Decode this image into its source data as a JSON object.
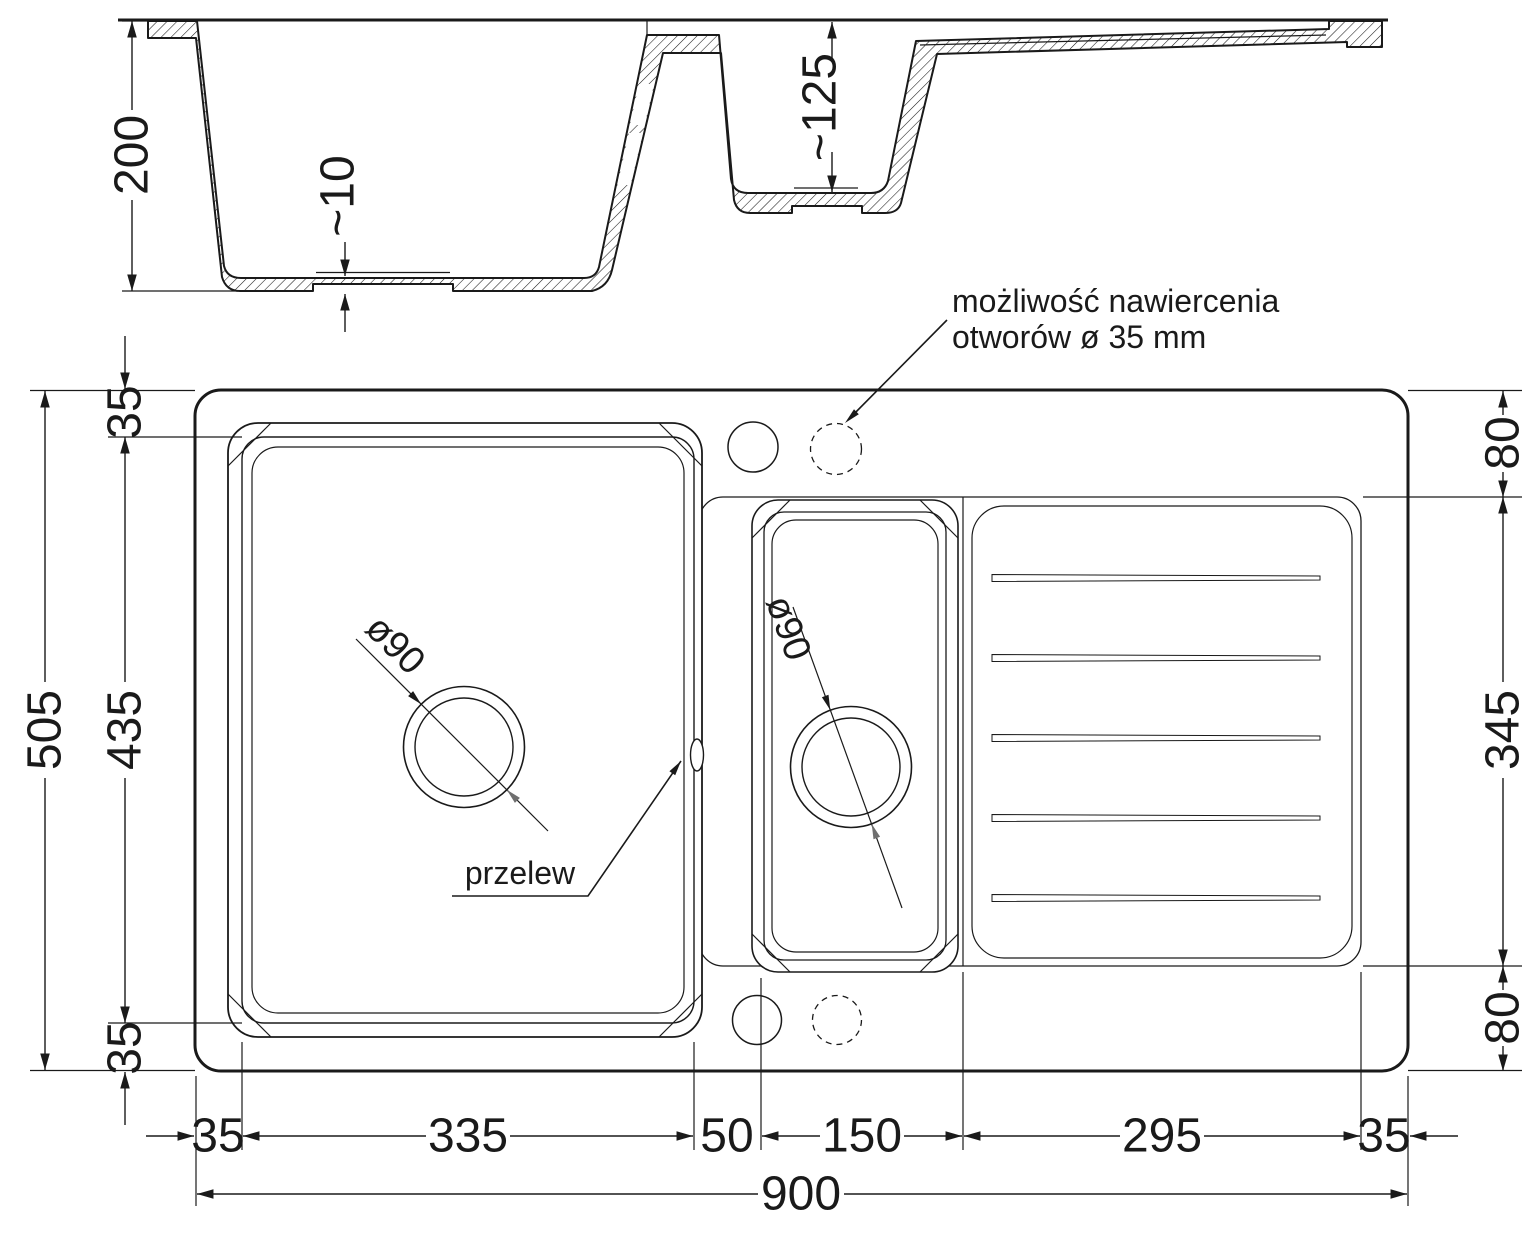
{
  "drawing": {
    "section": {
      "depth_total": "200",
      "floor_thickness": "~10",
      "small_bowl_depth": "~125"
    },
    "plan": {
      "drill_note_line1": "możliwość nawiercenia",
      "drill_note_line2": "otworów ø 35 mm",
      "overflow_label": "przelew",
      "main_drain_diameter": "ø90",
      "small_drain_diameter": "ø90",
      "dims": {
        "total_width": "900",
        "total_depth": "505",
        "bowl_inner_depth": "435",
        "margin_top": "35",
        "margin_bottom": "35",
        "margin_left": "35",
        "margin_right": "35",
        "main_bowl_width": "335",
        "divider_gap": "50",
        "small_bowl_width": "150",
        "drainboard_width": "295",
        "deck_top": "80",
        "deck_middle": "345",
        "deck_bottom": "80"
      }
    }
  },
  "colors": {
    "line": "#1a1a1a",
    "gray_arrow": "#6f6f6f",
    "background": "#ffffff"
  }
}
